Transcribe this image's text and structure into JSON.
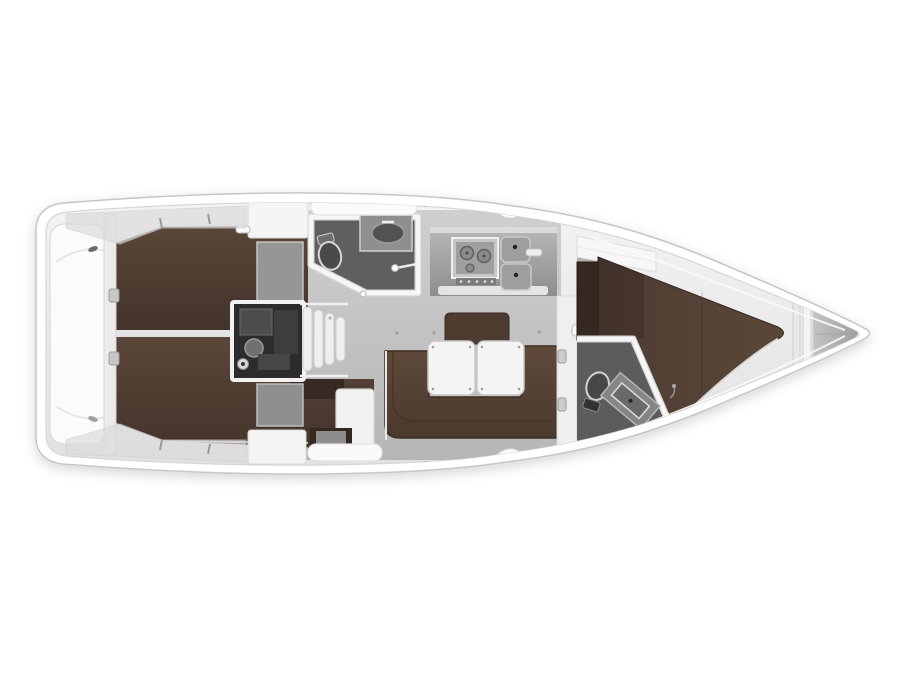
{
  "figure": {
    "type": "yacht floor plan",
    "view": "top-down",
    "orientation_bow": "right",
    "orientation_stern": "left",
    "background": "#ffffff",
    "aria_label": "Top-down interior floor plan of a sailing yacht, bow pointing right"
  },
  "palette": {
    "hull_white": "#ffffff",
    "hull_outline": "#c6c6c6",
    "deck_gray": "#ececec",
    "coaming_gray": "#dcdcdc",
    "saloon_floor": "#c6c6c6",
    "wetroom_floor": "#5e5e5e",
    "upholstery_dark": "#44342a",
    "upholstery_light": "#5d4a3c",
    "settee_brown": "#55422f",
    "wardrobe_dark": "#342821",
    "table_white": "#f5f5f5",
    "counter_gray": "#a5a5a5",
    "engine_dark": "#2c2c2c",
    "anchor_gray": "#b5b5b5"
  },
  "compartments": {
    "swim_platform": {
      "name": "Stern swim platform and transom seat",
      "features": [
        "molded platform",
        "mooring cleats"
      ]
    },
    "transom": {
      "name": "Transom wall with ladder fittings",
      "features": [
        "two hinge fittings"
      ]
    },
    "aft_cabin_port": {
      "name": "Aft cabin, port side (top)",
      "features": [
        "double berth",
        "white locker",
        "gray wardrobe"
      ]
    },
    "aft_cabin_starboard": {
      "name": "Aft cabin, starboard side (bottom)",
      "features": [
        "double berth",
        "headboard",
        "locker",
        "cabinet"
      ]
    },
    "engine_compartment": {
      "name": "Engine compartment under companionway",
      "features": [
        "engine block",
        "filter",
        "pulley"
      ]
    },
    "companionway": {
      "name": "Companionway steps",
      "features": [
        "four curved treads"
      ]
    },
    "aft_head": {
      "name": "Aft head (wet room)",
      "features": [
        "marine toilet",
        "vanity with oval basin",
        "hand shower",
        "angled door"
      ]
    },
    "galley": {
      "name": "Galley",
      "features": [
        "gimballed stove with burners",
        "knob row",
        "double sink",
        "faucet",
        "worktop"
      ]
    },
    "saloon": {
      "name": "Saloon",
      "features": [
        "U-shaped settee",
        "folding table with two leaves",
        "bench backrest",
        "floor fittings"
      ]
    },
    "nav_area": {
      "name": "Navigation / seat area",
      "features": [
        "white seat panel",
        "dark console"
      ]
    },
    "forward_head": {
      "name": "Forward head (wet room)",
      "features": [
        "marine toilet",
        "angled vanity with sink",
        "angled partition"
      ]
    },
    "forward_cabin": {
      "name": "Forward cabin",
      "features": [
        "V-berth double",
        "wardrobe",
        "shelf locker",
        "entry door"
      ]
    },
    "anchor_locker": {
      "name": "Bow anchor locker",
      "features": [
        "divider bulkheads",
        "chain locker wedge"
      ]
    },
    "side_decks": {
      "name": "Side decks",
      "features": [
        "toe rail lines",
        "stanchion bases",
        "chainplate notches",
        "grab rail panels"
      ]
    }
  }
}
